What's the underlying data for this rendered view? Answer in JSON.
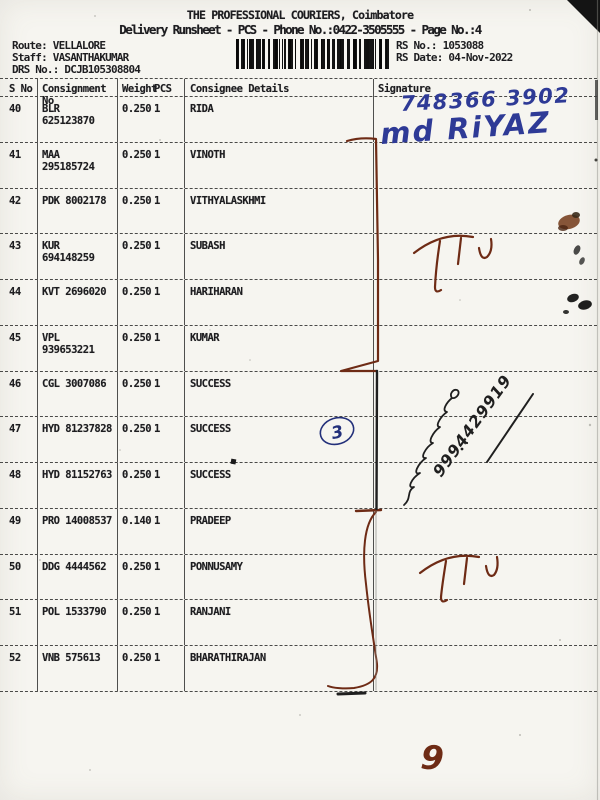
{
  "document": {
    "title": "THE PROFESSIONAL COURIERS, Coimbatore",
    "subtitle": "Delivery Runsheet - PCS - Phone No.:0422-3505555 - Page No.:4",
    "route_label": "Route:",
    "route_value": "VELLALORE",
    "staff_label": "Staff:",
    "staff_value": "VASANTHAKUMAR",
    "drs_label": "DRS No.:",
    "drs_value": "DCJB105308804",
    "rs_no_label": "RS No.:",
    "rs_no_value": "1053088",
    "rs_date_label": "RS Date:",
    "rs_date_value": "04-Nov-2022"
  },
  "table": {
    "columns": {
      "s_no": "S No",
      "consignment_no": "Consignment No",
      "weight": "Weight",
      "pcs": "PCS",
      "consignee": "Consignee Details",
      "signature": "Signature"
    },
    "rows": [
      {
        "s_no": "40",
        "consignment_no": "BLR 625123870",
        "weight": "0.250",
        "pcs": "1",
        "consignee": "RIDA"
      },
      {
        "s_no": "41",
        "consignment_no": "MAA 295185724",
        "weight": "0.250",
        "pcs": "1",
        "consignee": "VINOTH"
      },
      {
        "s_no": "42",
        "consignment_no": "PDK 8002178",
        "weight": "0.250",
        "pcs": "1",
        "consignee": "VITHYALASKHMI"
      },
      {
        "s_no": "43",
        "consignment_no": "KUR 694148259",
        "weight": "0.250",
        "pcs": "1",
        "consignee": "SUBASH"
      },
      {
        "s_no": "44",
        "consignment_no": "KVT 2696020",
        "weight": "0.250",
        "pcs": "1",
        "consignee": "HARIHARAN"
      },
      {
        "s_no": "45",
        "consignment_no": "VPL 939653221",
        "weight": "0.250",
        "pcs": "1",
        "consignee": "KUMAR"
      },
      {
        "s_no": "46",
        "consignment_no": "CGL 3007086",
        "weight": "0.250",
        "pcs": "1",
        "consignee": "SUCCESS"
      },
      {
        "s_no": "47",
        "consignment_no": "HYD 81237828",
        "weight": "0.250",
        "pcs": "1",
        "consignee": "SUCCESS"
      },
      {
        "s_no": "48",
        "consignment_no": "HYD 81152763",
        "weight": "0.250",
        "pcs": "1",
        "consignee": "SUCCESS"
      },
      {
        "s_no": "49",
        "consignment_no": "PRO 14008537",
        "weight": "0.140",
        "pcs": "1",
        "consignee": "PRADEEP"
      },
      {
        "s_no": "50",
        "consignment_no": "DDG 4444562",
        "weight": "0.250",
        "pcs": "1",
        "consignee": "PONNUSAMY"
      },
      {
        "s_no": "51",
        "consignment_no": "POL 1533790",
        "weight": "0.250",
        "pcs": "1",
        "consignee": "RANJANI"
      },
      {
        "s_no": "52",
        "consignment_no": "VNB 575613",
        "weight": "0.250",
        "pcs": "1",
        "consignee": "BHARATHIRAJAN"
      }
    ]
  },
  "handwriting": {
    "mobile_top": "748366 3902",
    "receiver_name": "md RiYAZ",
    "circled_count": "3",
    "mobile_diagonal": "9994429919",
    "page_number_note": "9"
  },
  "ink_colors": {
    "blue": "#2e3a96",
    "brown": "#6e2b15",
    "black": "#1f1f1f"
  }
}
